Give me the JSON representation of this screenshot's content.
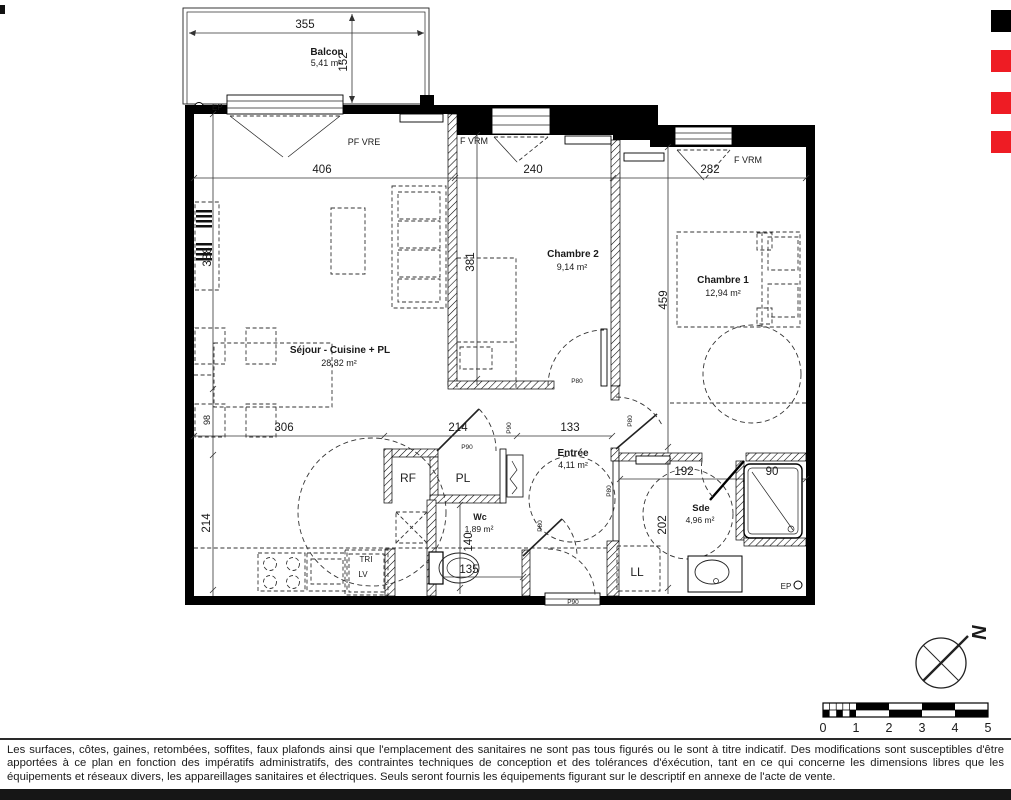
{
  "colors": {
    "mark_red": "#ee1c24",
    "mark_black": "#000000",
    "ink": "#1a1a1a"
  },
  "plan": {
    "balcony": {
      "name": "Balcon",
      "area": "5,41 m²",
      "dim_width": "355",
      "dim_depth": "152",
      "drain": "EP"
    },
    "facade": {
      "window_left": "PF VRE",
      "window_mid": "F VRM",
      "window_right": "F VRM",
      "dim_left": "406",
      "dim_mid": "240",
      "dim_right": "282"
    },
    "sejour": {
      "name": "Séjour - Cuisine + PL",
      "area": "28,82 m²",
      "dim_side_upper": "388",
      "dim_side_small": "98",
      "dim_side_lower": "214",
      "dim_bottom_left": "306",
      "dim_bottom_mid": "214",
      "dim_bottom_right": "133",
      "fridge": "RF",
      "closet": "PL",
      "sorting": "TRI",
      "dishwasher": "LV"
    },
    "chambre2": {
      "name": "Chambre 2",
      "area": "9,14 m²",
      "dim_height": "381"
    },
    "chambre1": {
      "name": "Chambre 1",
      "area": "12,94 m²",
      "dim_height": "459"
    },
    "entree": {
      "name": "Entrée",
      "area": "4,11 m²"
    },
    "wc": {
      "name": "Wc",
      "area": "1,89 m²",
      "dim_height": "140",
      "dim_width": "135"
    },
    "sde": {
      "name": "Sde",
      "area": "4,96 m²",
      "dim_width": "192",
      "dim_shower": "90",
      "dim_height": "202",
      "washer": "LL",
      "drain": "EP"
    },
    "doors": {
      "sejour": "P90",
      "hall": "P90",
      "front": "P90",
      "wc": "P80",
      "sde": "P80",
      "chambre1": "P80",
      "chambre2": "P80"
    },
    "compass": {
      "north": "N"
    }
  },
  "scalebar": {
    "labels": [
      "0",
      "1",
      "2",
      "3",
      "4",
      "5"
    ]
  },
  "footer": {
    "disclaimer": "Les surfaces, côtes, gaines, retombées, soffites, faux plafonds ainsi que l'emplacement des sanitaires ne sont pas tous figurés ou le sont à titre indicatif. Des modifications sont susceptibles d'être apportées à ce plan en fonction des impératifs administratifs, des contraintes techniques de conception et des tolérances d'éxécution, tant en ce qui concerne les dimensions libres que les équipements et réseaux divers, les appareillages sanitaires et électriques. Seuls seront fournis les équipements figurant sur le descriptif en annexe de l'acte de vente."
  }
}
